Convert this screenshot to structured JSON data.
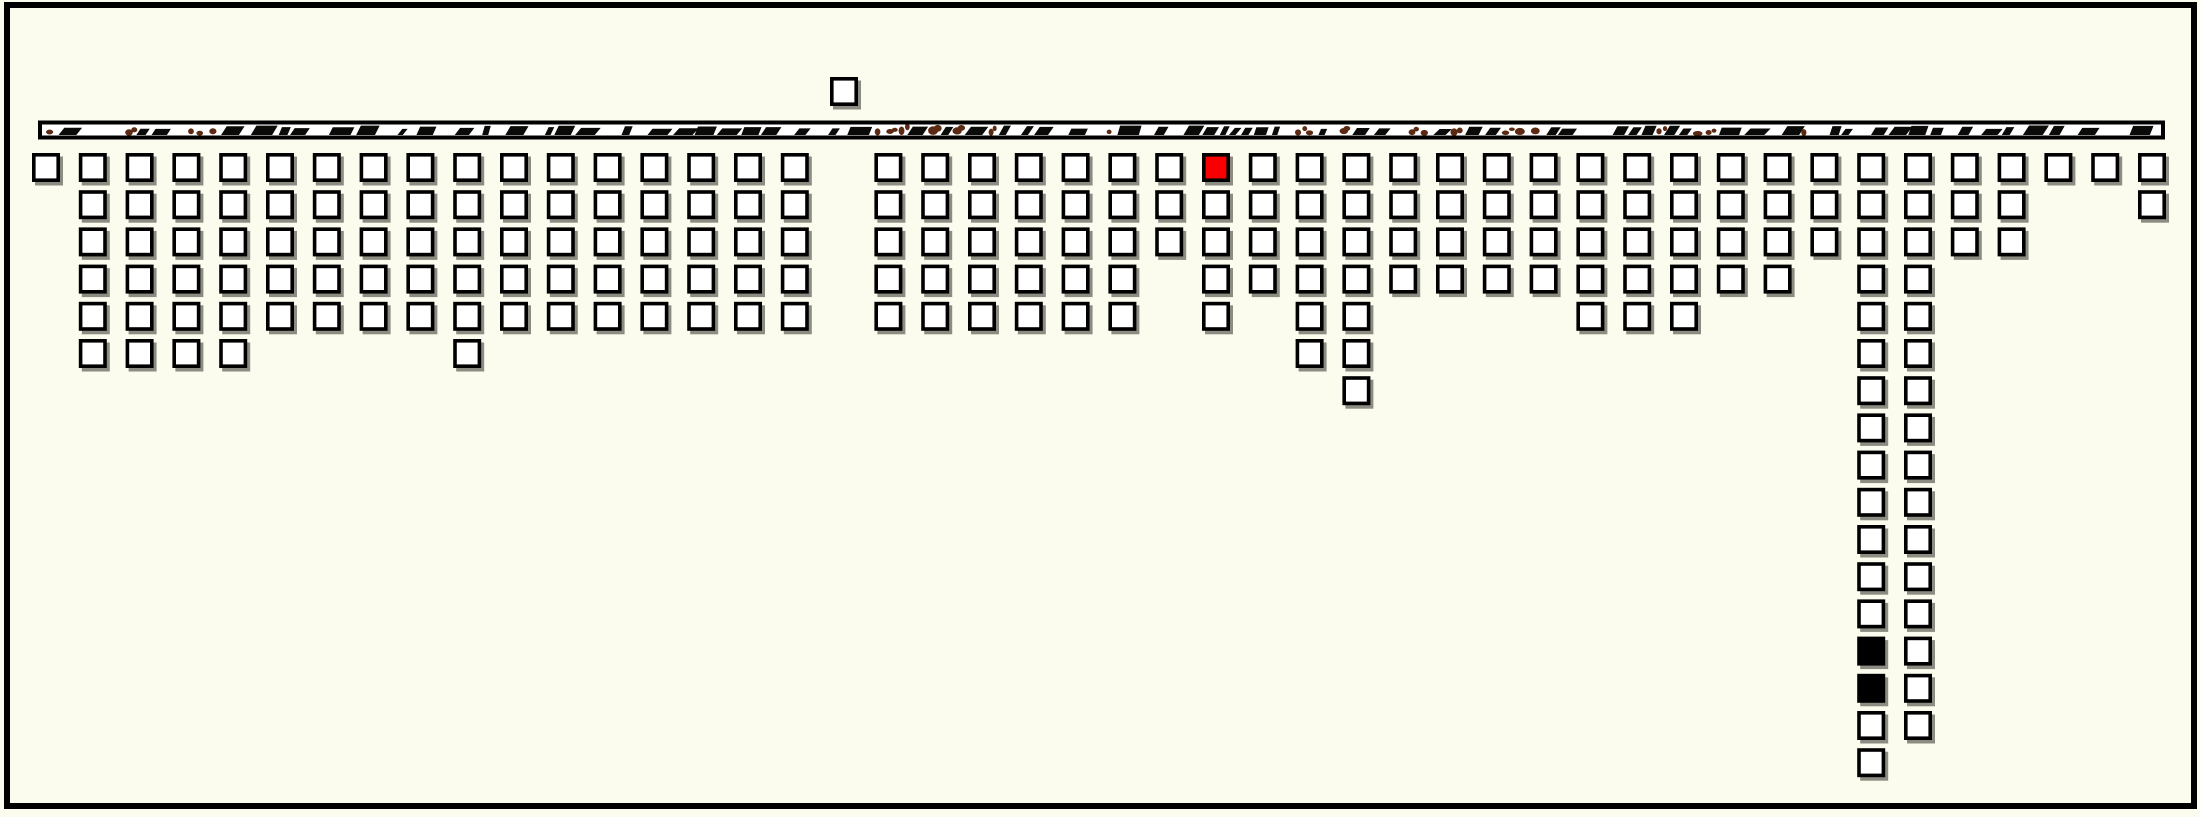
{
  "page": {
    "background": "#fcfcee",
    "frame_border_color": "#000000"
  },
  "colors": {
    "square_fill": "#ffffff",
    "square_outline": "#000000",
    "square_shadow": "#8c8c82",
    "highlight_red": "#f80000",
    "selected_black": "#000000",
    "axis_strip_fill": "#ffffff",
    "axis_strip_border": "#000000",
    "axis_mark_black": "#0a0a08",
    "axis_mark_brown": "#5c2a12"
  },
  "chart_data": {
    "type": "bar",
    "subtype": "unit-square-columns-hanging-from-top-axis",
    "title": "",
    "xlabel": "",
    "ylabel": "",
    "legend": "none",
    "grid": "off",
    "axis": {
      "position": "top",
      "style": "horizontal strip with illegible micro tick-marks",
      "tick_label_style": "illegible-micro-marks"
    },
    "num_columns": 46,
    "column_gap_indices": [
      17
    ],
    "values": [
      1,
      6,
      6,
      6,
      6,
      5,
      5,
      5,
      5,
      6,
      5,
      5,
      5,
      5,
      5,
      5,
      5,
      0,
      5,
      5,
      5,
      5,
      5,
      5,
      3,
      5,
      4,
      6,
      7,
      4,
      4,
      4,
      4,
      5,
      5,
      5,
      4,
      4,
      3,
      17,
      16,
      3,
      3,
      1,
      1,
      2
    ],
    "max_value": 17,
    "highlights": {
      "red_cell": {
        "column": 25,
        "row": 1
      },
      "black_cells": [
        {
          "column": 39,
          "row": 14
        },
        {
          "column": 39,
          "row": 15
        }
      ]
    },
    "floating_unit": {
      "column": 17,
      "position": "above-axis"
    }
  }
}
